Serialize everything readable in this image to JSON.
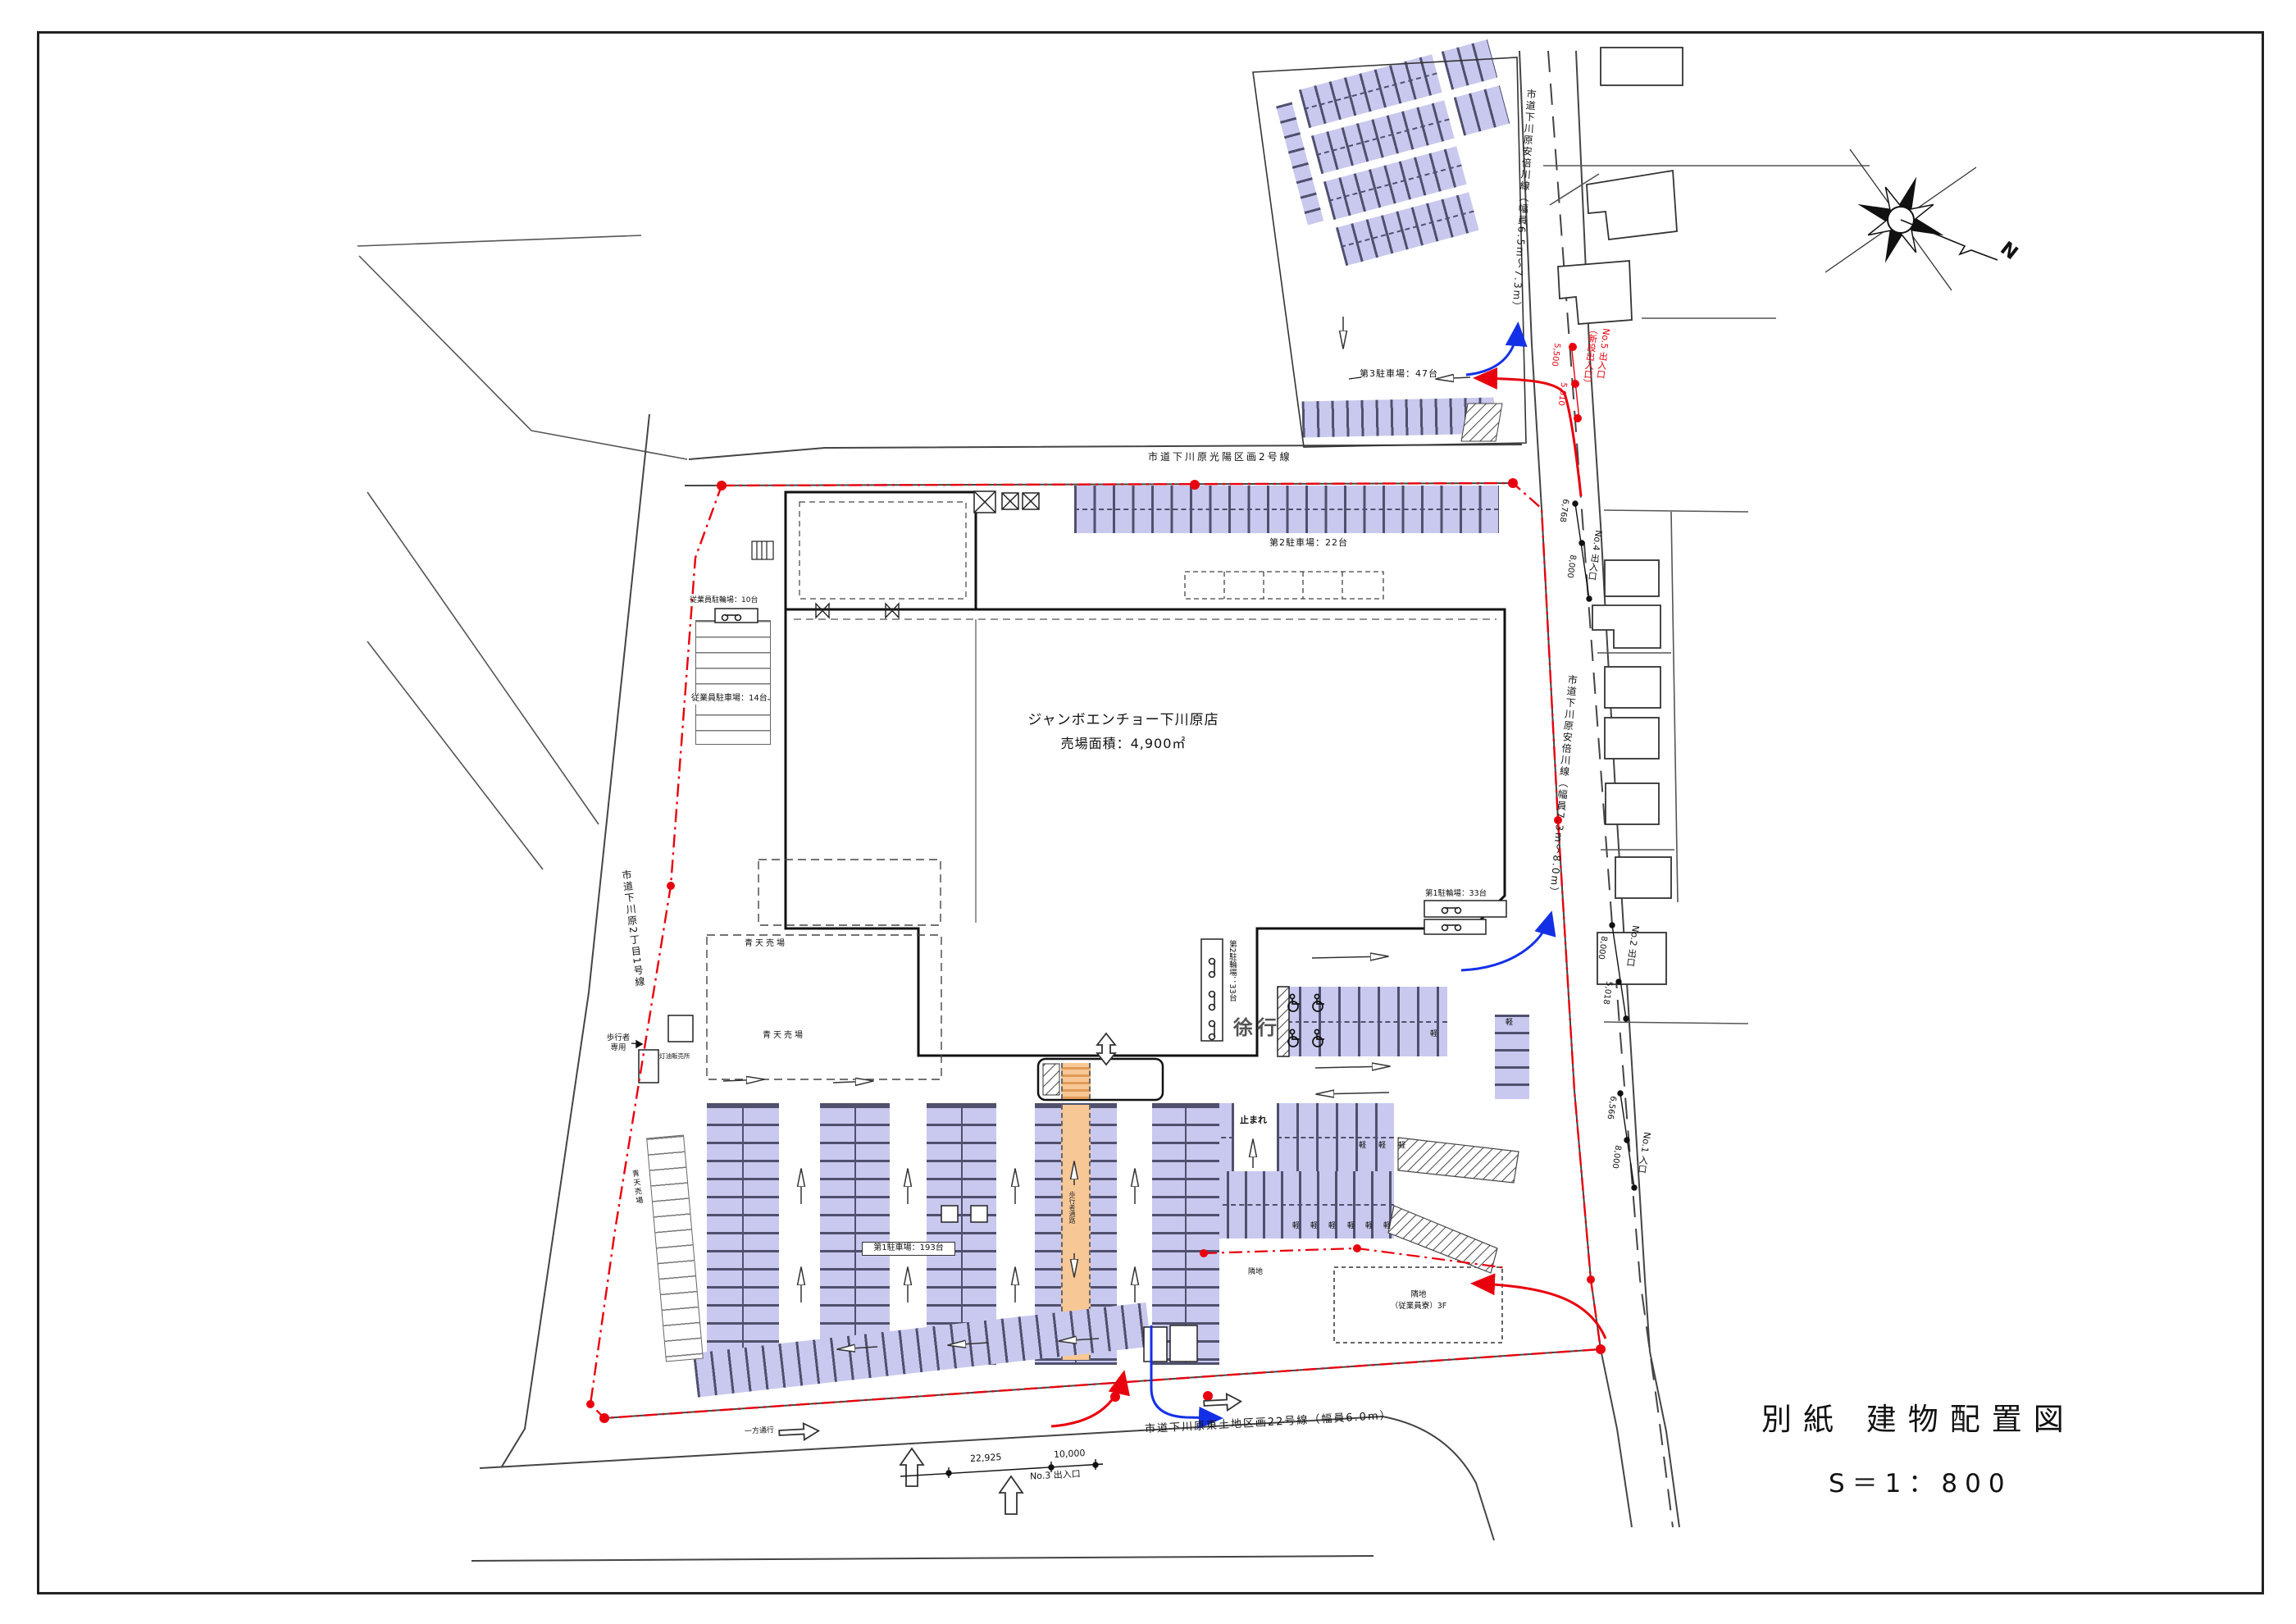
{
  "page": {
    "title": "別紙 建物配置図",
    "scale": "S＝1：800"
  },
  "building": {
    "name": "ジャンボエンチョー下川原店",
    "area": "売場面積：4,900㎡"
  },
  "roads": {
    "top": "市道下川原光陽区画2号線",
    "top_right": "市道下川原安倍川線（幅員6.5m～7.3m）",
    "right": "市道下川原安倍川線（幅員7.3m～8.0m）",
    "bottom": "市道下川原東土地区画22号線（幅員6.0m）",
    "left": "市道下川原2丁目1号線"
  },
  "parking": {
    "lot1": "第1駐車場：193台",
    "lot2": "第2駐車場：22台",
    "lot3": "第3駐車場：47台",
    "bike1": "第1駐輪場：33台",
    "bike2": "第2駐輪場：33台",
    "staff_car": "従業員駐車場：14台",
    "staff_bike": "従業員駐輪場：10台"
  },
  "entrances": {
    "no1": {
      "label": "No.1 入口",
      "dim1": "6,566",
      "dim2": "8,000"
    },
    "no2": {
      "label": "No.2 出口",
      "dim1": "8,000",
      "dim2": "5,018"
    },
    "no3": {
      "label": "No.3 出入口",
      "dim1": "22,925",
      "dim2": "10,000"
    },
    "no4": {
      "label": "No.4 出入口",
      "dim1": "6,768",
      "dim2": "8,000"
    },
    "no5": {
      "label": "No.5 出入口",
      "sub": "（新設出入口）",
      "dim1": "5,500",
      "dim2": "5,010"
    }
  },
  "labels": {
    "open_air": "青天売場",
    "slow": "徐行",
    "stop": "止まれ",
    "kei": "軽",
    "one_way": "一方通行",
    "ped_only": "歩行者専用",
    "kerosene": "灯油販売所",
    "walkway": "歩行者通路",
    "adjacent": "隣地",
    "dorm1": "隣地",
    "dorm2": "（従業員寮）3F",
    "north": "N"
  },
  "colors": {
    "stall_fill": "#c9c9ef",
    "stall_line": "#50506e",
    "walkway_orange": "#f7c795",
    "boundary_red": "#e8000d",
    "flow_blue": "#1430e6"
  }
}
